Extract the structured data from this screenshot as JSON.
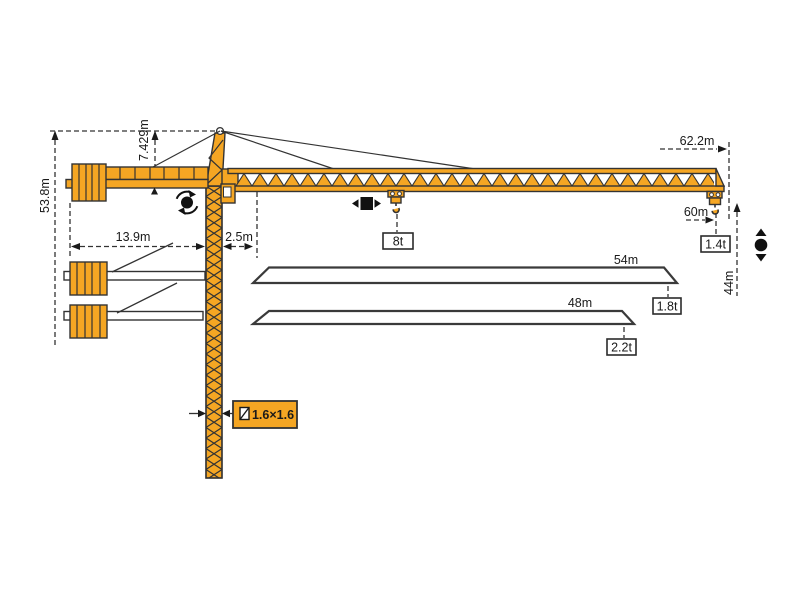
{
  "diagram": {
    "title": "tower-crane-working-range-diagram",
    "colors": {
      "crane": "#F5A623",
      "line": "#333333",
      "background": "#ffffff"
    }
  },
  "labels": {
    "total_height": "53.8m",
    "head_height": "7.429m",
    "counterjib_radius": "13.9m",
    "min_radius": "2.5m",
    "max_radius": "62.2m",
    "hook_radius": "60m",
    "tip_load": "1.4t",
    "hook_height": "44m",
    "max_load": "8t",
    "jib54": "54m",
    "jib54_load": "1.8t",
    "jib48": "48m",
    "jib48_load": "2.2t",
    "mast_section": "1.6×1.6"
  },
  "icons": {
    "slewing": "slewing-rotation-icon",
    "trolley": "trolley-travel-icon",
    "hoist": "hook-hoist-icon",
    "section": "mast-cross-section-icon"
  }
}
